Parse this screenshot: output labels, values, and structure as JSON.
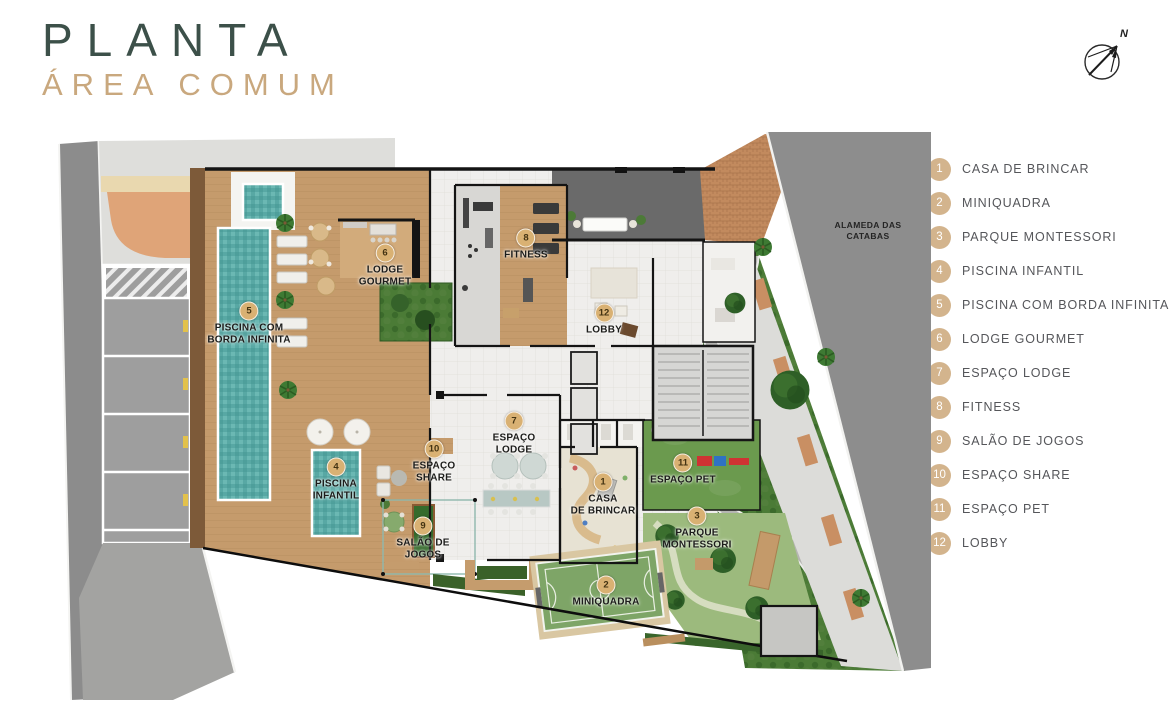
{
  "header": {
    "title": "PLANTA",
    "subtitle": "ÁREA COMUM"
  },
  "compass": {
    "label": "N"
  },
  "plan": {
    "street_label": "ALAMEDA DAS\nCATABAS",
    "labels": {
      "p1": {
        "num": "1",
        "text": "CASA\nDE BRINCAR"
      },
      "p2": {
        "num": "2",
        "text": "MINIQUADRA"
      },
      "p3": {
        "num": "3",
        "text": "PARQUE\nMONTESSORI"
      },
      "p4": {
        "num": "4",
        "text": "PISCINA\nINFANTIL"
      },
      "p5": {
        "num": "5",
        "text": "PISCINA COM\nBORDA INFINITA"
      },
      "p6": {
        "num": "6",
        "text": "LODGE\nGOURMET"
      },
      "p7": {
        "num": "7",
        "text": "ESPAÇO\nLODGE"
      },
      "p8": {
        "num": "8",
        "text": "FITNESS"
      },
      "p9": {
        "num": "9",
        "text": "SALÃO DE\nJOGOS"
      },
      "p10": {
        "num": "10",
        "text": "ESPAÇO\nSHARE"
      },
      "p11": {
        "num": "11",
        "text": "ESPAÇO PET"
      },
      "p12": {
        "num": "12",
        "text": "LOBBY"
      }
    }
  },
  "legend": {
    "items": [
      {
        "num": "1",
        "label": "CASA DE BRINCAR"
      },
      {
        "num": "2",
        "label": "MINIQUADRA"
      },
      {
        "num": "3",
        "label": "PARQUE MONTESSORI"
      },
      {
        "num": "4",
        "label": "PISCINA INFANTIL"
      },
      {
        "num": "5",
        "label": "PISCINA COM BORDA INFINITA"
      },
      {
        "num": "6",
        "label": "LODGE GOURMET"
      },
      {
        "num": "7",
        "label": "ESPAÇO LODGE"
      },
      {
        "num": "8",
        "label": "FITNESS"
      },
      {
        "num": "9",
        "label": "SALÃO DE JOGOS"
      },
      {
        "num": "10",
        "label": "ESPAÇO SHARE"
      },
      {
        "num": "11",
        "label": "ESPAÇO PET"
      },
      {
        "num": "12",
        "label": "LOBBY"
      }
    ]
  },
  "colors": {
    "title_green": "#3c5049",
    "subtitle_tan": "#c9a87e",
    "legend_badge": "#d3b48d",
    "pool_teal": "#58a8a4",
    "deck_wood": "#c59b6c",
    "street_gray": "#8d8d8d",
    "garden_green": "#4b7b36",
    "court_green": "#7ea567",
    "brick": "#c28a5e"
  }
}
